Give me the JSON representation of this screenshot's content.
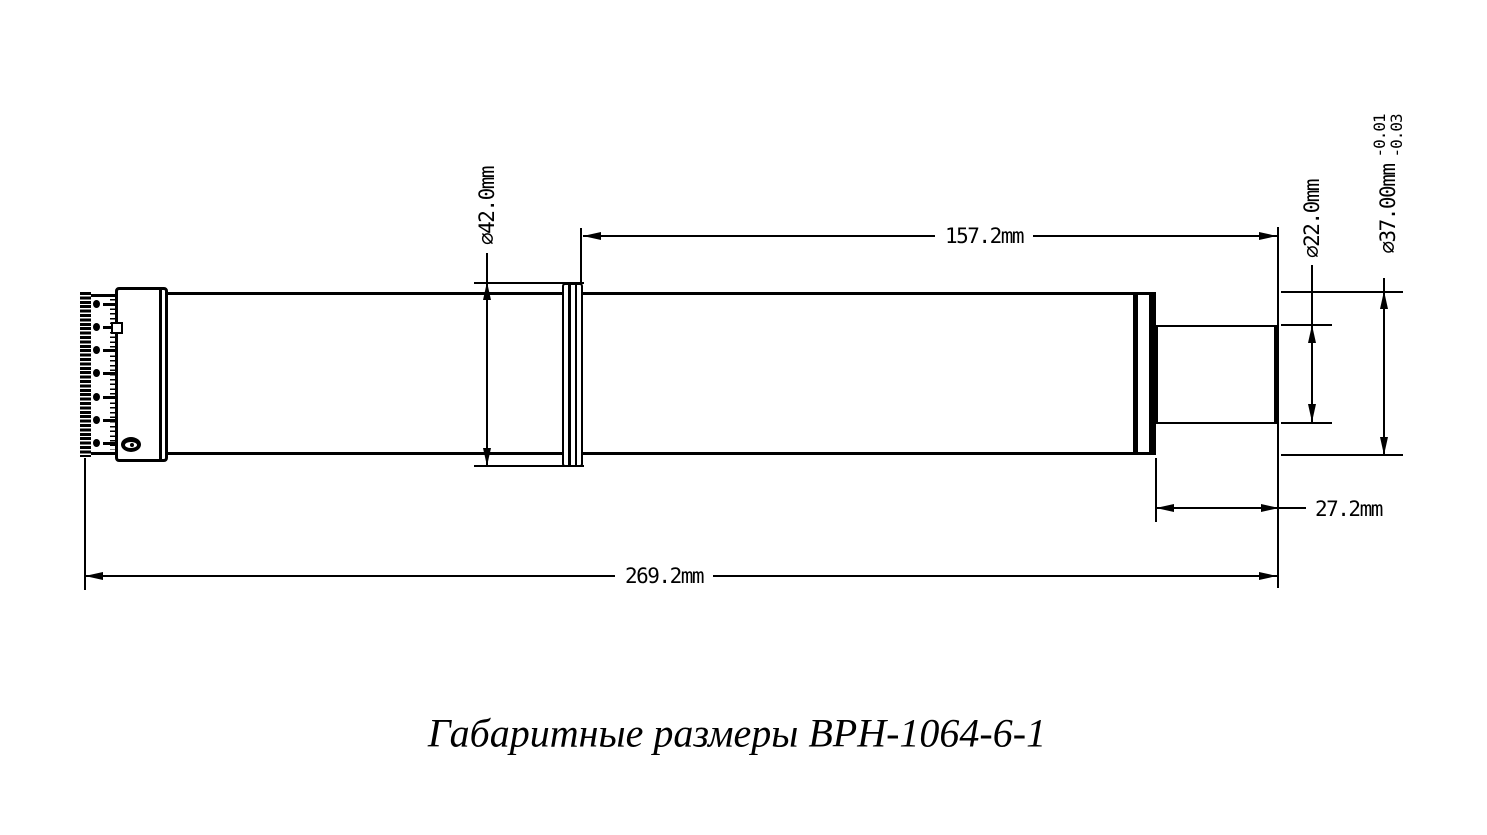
{
  "page": {
    "background": "#ffffff",
    "line_color": "#000000"
  },
  "title": {
    "text": "Габаритные размеры BPH-1064-6-1"
  },
  "dimensions": {
    "collar_diameter": {
      "label": "⌀42.0mm"
    },
    "front_section_length": {
      "label": "157.2mm"
    },
    "tip_diameter": {
      "label": "⌀22.0mm"
    },
    "body_diameter": {
      "label": "⌀37.00mm",
      "tolerance_upper": "-0.01",
      "tolerance_lower": "-0.03"
    },
    "tip_length": {
      "label": "27.2mm"
    },
    "overall_length": {
      "label": "269.2mm"
    }
  }
}
